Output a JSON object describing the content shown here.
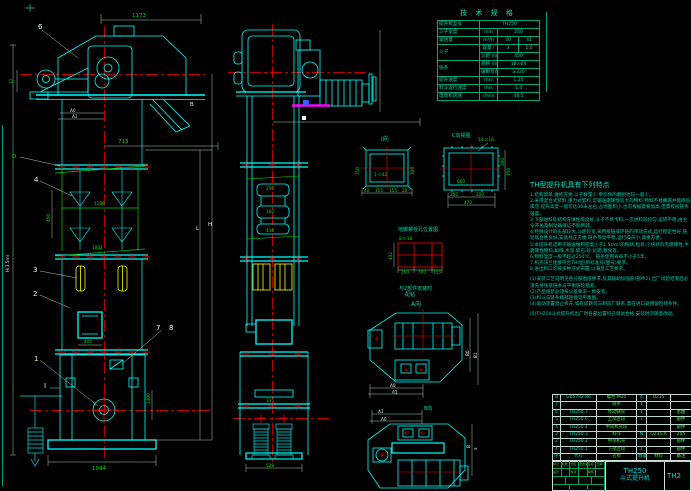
{
  "colors": {
    "bg": "#000000",
    "line_cyan": "#00ffff",
    "line_red": "#ff0000",
    "line_green": "#00e800",
    "line_yellow": "#ffff00",
    "line_magenta": "#ff00ff",
    "text_teal": "#00d8a8",
    "text_white": "#e8f8f0"
  },
  "spec_table": {
    "title": "技 术 规 格",
    "rows": [
      [
        "提升机型号",
        {
          "t": "TH250",
          "c": 3
        }
      ],
      [
        "斗子宽度",
        "mm",
        {
          "t": "250",
          "c": 2
        }
      ],
      [
        "输送量",
        "m³/h",
        "30",
        "41"
      ],
      [
        {
          "t": "斗子",
          "rs": 2
        },
        "容量 l",
        "3",
        "1.5"
      ],
      [
        "斗距 mm",
        {
          "t": "450",
          "c": 2
        }
      ],
      [
        {
          "t": "链条",
          "rs": 2
        },
        "规格 mm",
        {
          "t": "18×64",
          "c": 2
        }
      ],
      [
        "破断负荷 kN",
        {
          "t": "≥320",
          "c": 2
        }
      ],
      [
        "提升速度",
        "m/s",
        {
          "t": "1.25",
          "c": 2
        }
      ],
      [
        "料斗运行速度",
        "m/s",
        {
          "t": "1.4",
          "c": 2
        }
      ],
      [
        "电动机转速",
        "r/min",
        {
          "t": "48.5",
          "c": 2
        }
      ]
    ]
  },
  "features": {
    "heading": "TH型提升机具有下列特点",
    "lines": [
      "1.结构简单,维修方便,斗子数量少,牵引件的磨损也较一般少。",
      "2.采用混合式装料,重力式卸料,可输送磨琢性较大的物料,物料不易撒漏并能降低噪音,提升高度一般可达30米左右,占地面积小,也可根据需要加高,但需校核链条强度。",
      "3.下部进料处结构充填性能良好,斗子不易卡料,一次进料较均匀,运转平稳,由主令开关及制动器保证不能倒转。",
      "4.特殊设计的头部较大,斗距较宽,采用板链或环链的传动方式,运行稳定性好,链轮啮合性良好,安装找正方便,链条传动平稳,运行噪声小,调换方便。",
      "5.本提升机适用于输送堆积密度小于1.5t/m³的粉状,粒状,小块状的无磨琢性,半磨琢性物料,如煤,水泥,碎石,砂,化肥,粮食等。",
      "6.物料温度一般不超过250℃。      链条使用寿命不小于5年。",
      "7.机壳法兰连接符合TH(图)的标准号(图号)要求。",
      "8.进出料口可按多种方式布置,以满足工艺要求。",
      "",
      "(1)安装工艺说明见各分部图纸要求,及其辅助加强筋(部件2),出厂试验结束后必须先将张紧链条与平衡链轮锁紧。",
      "(2)产品组装必须按公差要求一致安装。",
      "(3)料斗与链条端部连接见平衡图。",
      "(4)驱动装置禁止拆开,如有问题可与制造厂联系,需在进口处预留检修条件。",
      "",
      "(5)TH250斗式提升机出厂时各部位置均已调试合格,安装时勿随意改动。"
    ]
  },
  "bom": {
    "rows": [
      [
        "8",
        "GB5782-86",
        "螺栓 M20",
        "4",
        "Q235",
        ""
      ],
      [
        "7",
        "",
        "链条",
        "1",
        "",
        ""
      ],
      [
        "6",
        "TH250.7",
        "传动链轮",
        "1",
        "",
        "总图"
      ],
      [
        "5",
        "TH250.6",
        "上部区段",
        "1",
        "",
        "部件"
      ],
      [
        "4",
        "TH250.4",
        "中间机壳段",
        "",
        "",
        "部件"
      ],
      [
        "3",
        "TH250.3",
        "料斗",
        "N",
        "Q235-A",
        "205"
      ],
      [
        "2",
        "TH250.2",
        "中部机壳",
        "",
        "",
        "部件"
      ],
      [
        "1",
        "TH250.1",
        "下部区段",
        "1",
        "",
        "部件"
      ],
      [
        "序号",
        "代号",
        "名称",
        "数量",
        "材料",
        "备注"
      ]
    ]
  },
  "title_block": {
    "model": "TH250",
    "product": "斗式提升机",
    "drawing_no": "TH2",
    "strip": [
      "标记",
      "处数",
      "分区",
      "更改文件号",
      "签名",
      "日期"
    ],
    "sign_row": [
      "设计",
      "",
      "校对",
      "",
      "审核",
      ""
    ]
  },
  "dims": {
    "d1173": "1173",
    "d713": "713",
    "d400": "400",
    "d1044": "1044",
    "d450": "450",
    "d1188": "1188",
    "d1002": "1002",
    "d12": "12",
    "dH": "H(3.5m)",
    "dL": "L",
    "dHr": "H",
    "dA0": "A0",
    "dA1": "A1",
    "dB": "B",
    "d1400": "1400",
    "s250": "250",
    "s160": "160",
    "s438": "438",
    "s335": "335",
    "s520": "520",
    "i40": "40",
    "i155a": "155",
    "i155b": "155",
    "i20": "20",
    "i300": "300",
    "i350": "350",
    "ihole": "1-∅42",
    "c250": "250",
    "c200": "200",
    "c470": "470",
    "c660": "660",
    "c350": "350",
    "c200r": "200",
    "chole": "14-∅18",
    "a432": "432",
    "a260": "260",
    "a300": "300",
    "a155": "155",
    "abolt": "8-∅18",
    "avB0": "B0",
    "avB1": "B1",
    "avA0": "A0",
    "avA1": "A1",
    "bvA0": "A0",
    "bvA1": "A1",
    "bvB": "B",
    "bva": "a"
  },
  "balloons": {
    "n1": "1",
    "n2": "2",
    "n3": "3",
    "n4": "4",
    "n6": "6",
    "n7": "7",
    "n8": "8",
    "secI": "I",
    "secB": "B",
    "secD": "D"
  },
  "labels": {
    "sectionI": "I向",
    "sectionC": "C向视图",
    "anchorTitle": "地脚螺栓孔位置图",
    "fitNote1": "与2部件安装时",
    "fitNote2": "配钻",
    "viewA": "A向",
    "viewB": "B向"
  }
}
